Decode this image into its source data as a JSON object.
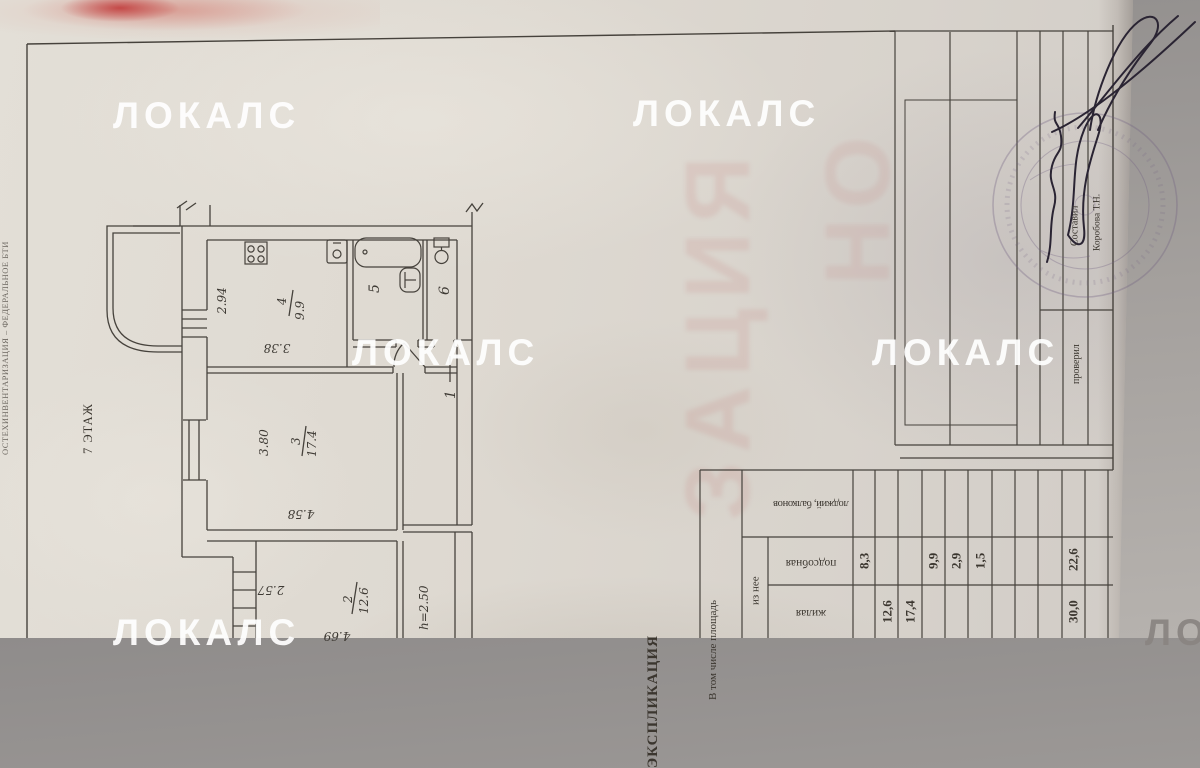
{
  "watermarks": {
    "brand": "ЛОКАЛС"
  },
  "edge_text": {
    "label": "ОСТЕХИНВЕНТАРИЗАЦИЯ – ФЕДЕРАЛЬНОЕ БТИ"
  },
  "floor": {
    "label": "7 ЭТАЖ"
  },
  "plan": {
    "bleed_text": "ЗАЦИЯ",
    "bleed_text2": "НО",
    "rooms": {
      "r1": "1",
      "r5": "5",
      "r6": "6",
      "r2_num": "2",
      "r2_area": "12.6",
      "r3_num": "3",
      "r3_area": "17.4",
      "r4_num": "4",
      "r4_area": "9.9"
    },
    "dims": {
      "d294": "2.94",
      "d338": "3.38",
      "d380": "3.80",
      "d458": "4.58",
      "d257": "2.57",
      "d469": "4.69",
      "height": "h=2.50"
    }
  },
  "title_block": {
    "compiled_label": "Составил",
    "compiled_name": "Коробова Т.Н.",
    "checked_label": "проверил"
  },
  "explication": {
    "title": "ЭКСПЛИКАЦИЯ",
    "header_span": "В том числе площадь",
    "header_sub": "из нее",
    "col_balcony": "лоджий, балконов",
    "col_utility": "подсобная",
    "col_living": "жилая",
    "utility": {
      "r1": "8,3",
      "r4": "9,9",
      "r5": "2,9",
      "r6": "1,5",
      "total": "22,6"
    },
    "living": {
      "r2": "12,6",
      "r3": "17,4",
      "total": "30,0"
    }
  }
}
